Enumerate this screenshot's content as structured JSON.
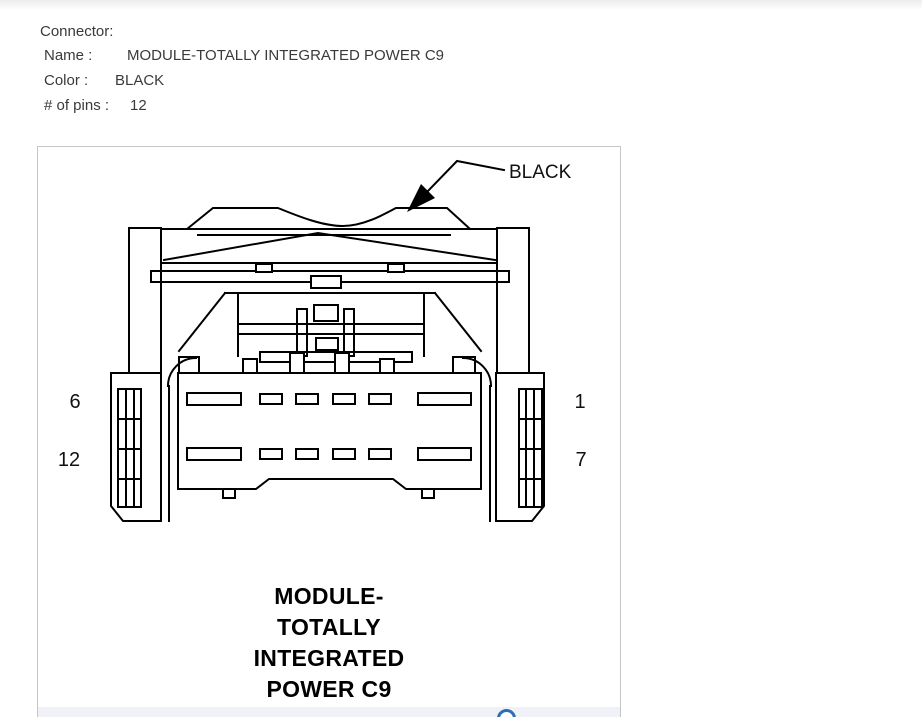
{
  "header": {
    "title": "Connector:",
    "fields": [
      {
        "label": "Name :",
        "value": "MODULE-TOTALLY INTEGRATED POWER C9"
      },
      {
        "label": "Color :",
        "value": "BLACK"
      },
      {
        "label": "# of pins :",
        "value": "12"
      }
    ]
  },
  "diagram": {
    "color_callout": "BLACK",
    "pins": {
      "top_left": "6",
      "top_right": "1",
      "bottom_left": "12",
      "bottom_right": "7"
    },
    "caption_lines": [
      "MODULE-",
      "TOTALLY",
      "INTEGRATED",
      "POWER C9"
    ],
    "colors": {
      "line": "#000000",
      "panel_border": "#c6c6c6",
      "footer_strip": "#f0f1f6",
      "accent_blue": "#2e6db5"
    }
  }
}
